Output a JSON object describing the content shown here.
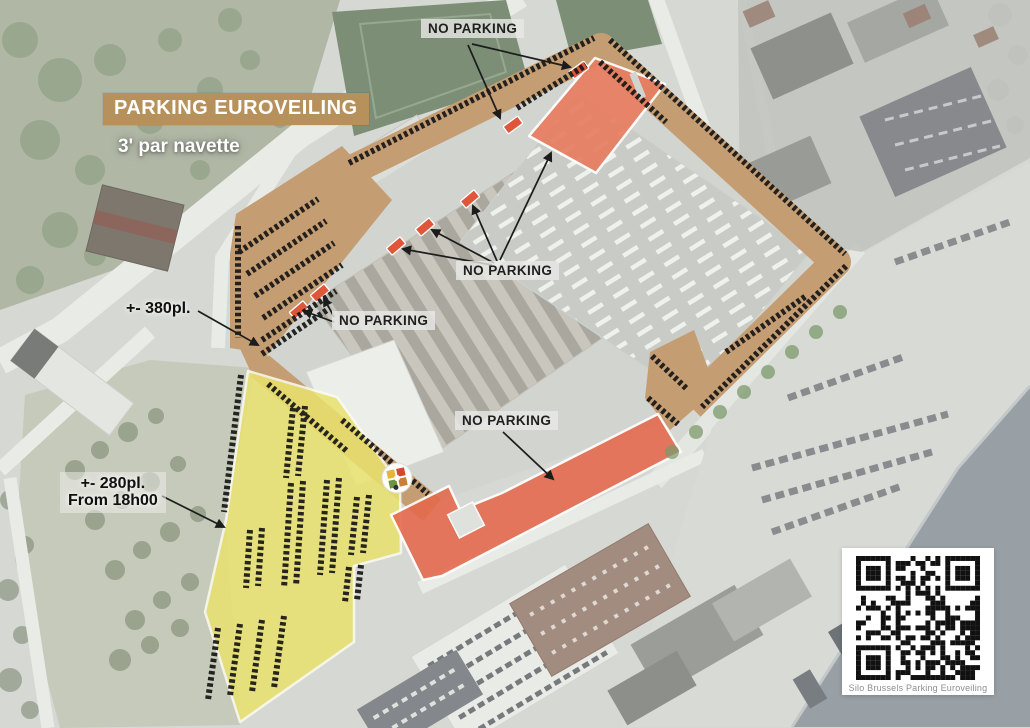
{
  "map": {
    "title": "PARKING EUROVEILING",
    "subtitle": "3' par navette",
    "no_parking_labels": [
      {
        "label": "NO PARKING"
      },
      {
        "label": "NO PARKING"
      },
      {
        "label": "NO PARKING"
      },
      {
        "label": "NO PARKING"
      }
    ],
    "capacity_main": "+- 380pl.",
    "capacity_evening_line1": "+- 280pl.",
    "capacity_evening_line2": "From 18h00",
    "qr_caption": "Silo Brussels Parking Euroveiling",
    "colors": {
      "title_bg": "#b7915c",
      "shuttle_parking_band": "#c59d72",
      "evening_parking_zone": "#e9e26e",
      "no_parking_zone": "#e8765a",
      "canal_water": "#98a0a6"
    }
  }
}
